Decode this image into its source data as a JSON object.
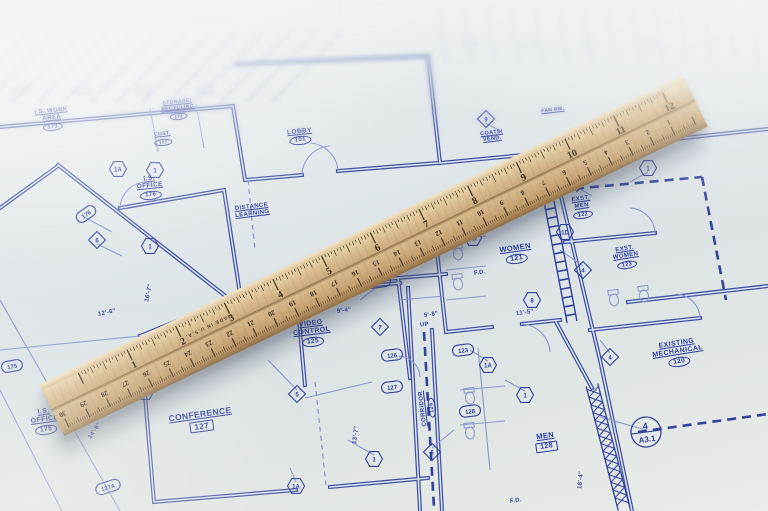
{
  "rooms": [
    {
      "name": "I.S. WORK\nAREA",
      "number": "173",
      "box": "oval"
    },
    {
      "name": "STORAGE/\nRECYCLING",
      "number": "172",
      "box": "oval"
    },
    {
      "name": "CUST.",
      "number": "177",
      "box": "oval"
    },
    {
      "name": "I.S.\nOFFICE",
      "number": "176",
      "box": "oval"
    },
    {
      "name": "I.S.\nOFFICE",
      "number": "175",
      "box": "oval"
    },
    {
      "name": "LOBBY",
      "number": "101",
      "box": "oval"
    },
    {
      "name": "COATS/\nVEND.",
      "number": "",
      "box": "none"
    },
    {
      "name": "FAN RM.",
      "number": "",
      "box": "none"
    },
    {
      "name": "CORRIDOR",
      "number": "103",
      "box": "oval"
    },
    {
      "name": "EXST.\nMEN",
      "number": "122",
      "box": "oval"
    },
    {
      "name": "EXST.\nWOMEN",
      "number": "123",
      "box": "oval"
    },
    {
      "name": "WOMEN",
      "number": "121",
      "box": "oval"
    },
    {
      "name": "EXISTING\nMECHANICAL",
      "number": "120",
      "box": "oval"
    },
    {
      "name": "VIDEO\nCONTROL",
      "number": "125",
      "box": "oval"
    },
    {
      "name": "DISTANCE\nLEARNING",
      "number": "",
      "box": "none"
    },
    {
      "name": "CONFERENCE",
      "number": "127",
      "box": "rect"
    },
    {
      "name": "MEN",
      "number": "128",
      "box": "rect"
    },
    {
      "name": "CORRIDOR",
      "number": "126",
      "box": "oval"
    }
  ],
  "door_tags": [
    "176",
    "175",
    "124A",
    "126",
    "127",
    "123",
    "128",
    "127A"
  ],
  "hex_callouts": [
    "1A",
    "1",
    "1",
    "1A",
    "1",
    "1D",
    "1D",
    "8",
    "1",
    "1A",
    "1",
    "1"
  ],
  "diamond_callouts": [
    "5",
    "7",
    "4",
    "4",
    "4",
    "6",
    "6",
    "9"
  ],
  "dimensions": [
    "13'-7\"",
    "9'-4\"",
    "12'-6\"",
    "14'-8\"",
    "16'-7\"",
    "11'-5\"",
    "5'-8\"",
    "18'-4\""
  ],
  "notes": [
    "UP",
    "F.D.",
    "F.D."
  ],
  "section_marker": {
    "top": "4",
    "bottom": "A3.1"
  },
  "ruler": {
    "made_in": "MADE IN U.S.A.",
    "inch_numbers": [
      "1",
      "2",
      "3",
      "4",
      "5",
      "6",
      "7",
      "8",
      "9",
      "10",
      "11",
      "12"
    ],
    "cm_numbers": [
      "1",
      "2",
      "3",
      "4",
      "5",
      "6",
      "7",
      "8",
      "9",
      "10",
      "11",
      "12",
      "13",
      "14",
      "15",
      "16",
      "17",
      "18",
      "19",
      "20",
      "21",
      "22",
      "23",
      "24",
      "25",
      "26",
      "27",
      "28",
      "29",
      "30"
    ]
  },
  "colors": {
    "ink": "#3d51a8",
    "ink_light": "#8a97cf",
    "text": "#2b3da0",
    "paper": "#e3e8e8",
    "wood": "#d6b88c",
    "wood_dark": "#b3905f"
  }
}
